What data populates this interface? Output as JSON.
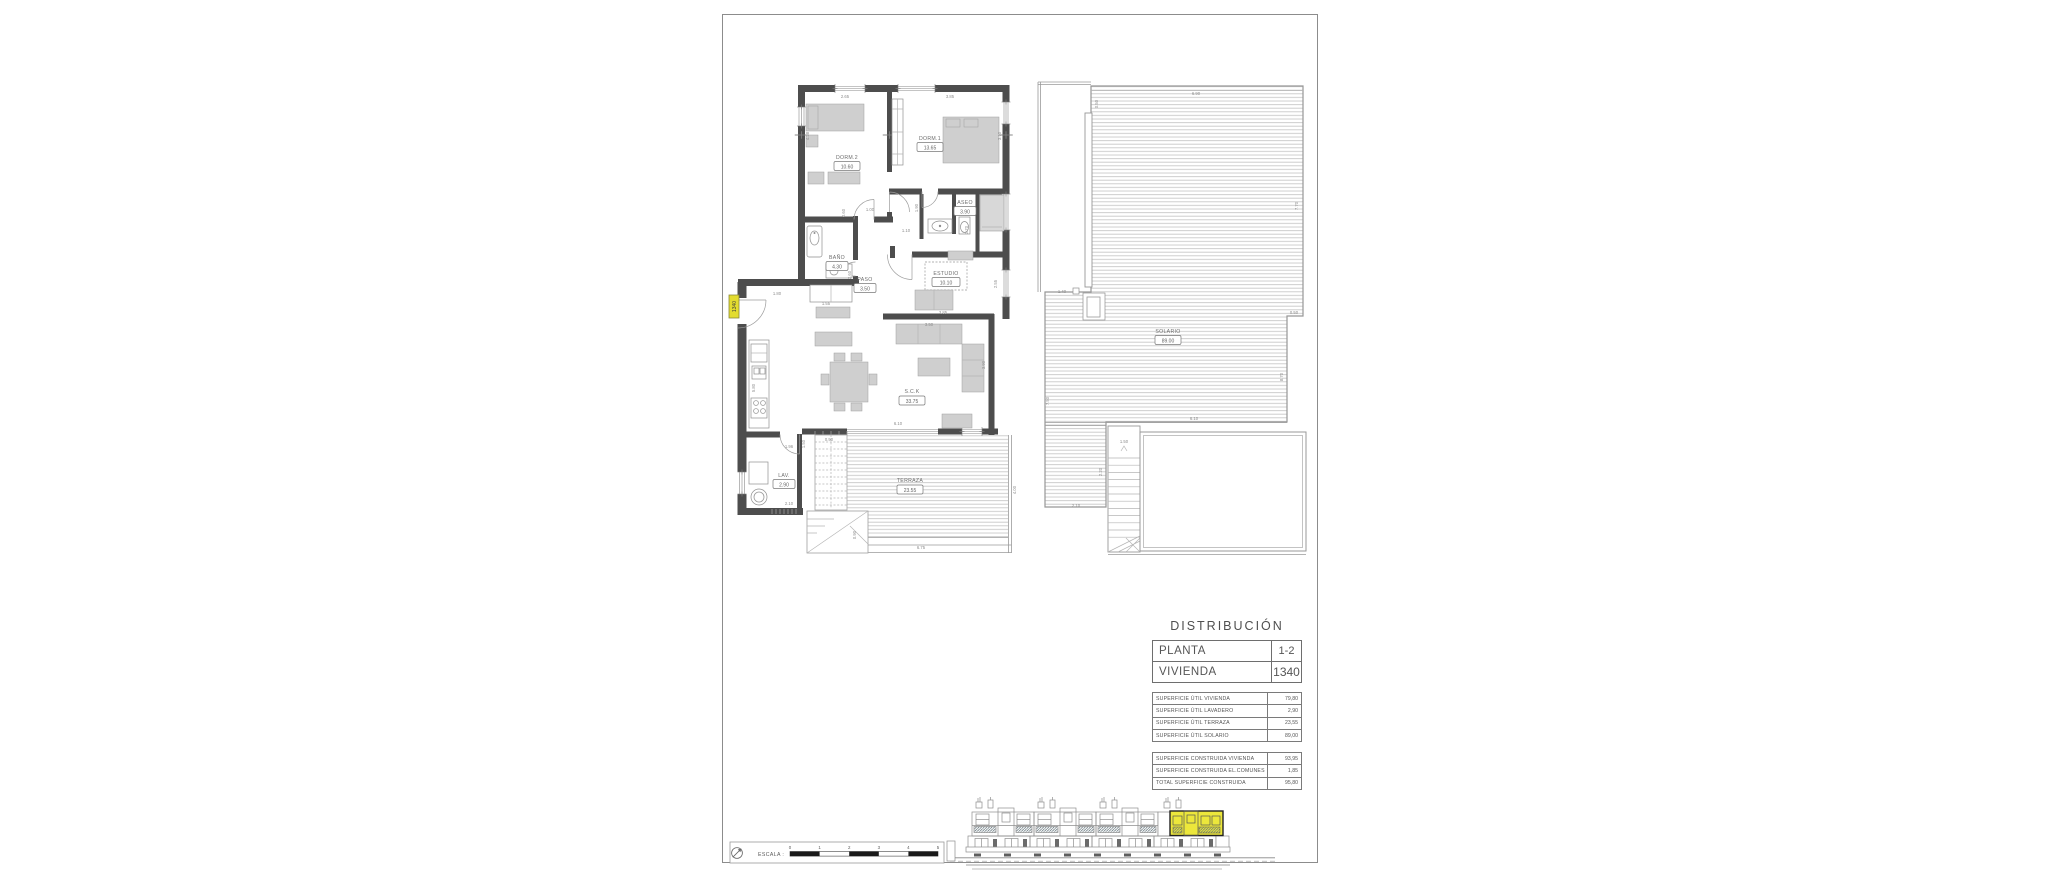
{
  "plan": {
    "rooms": [
      {
        "name": "DORM.2",
        "area": "10.60"
      },
      {
        "name": "DORM.1",
        "area": "13.65"
      },
      {
        "name": "ASEO",
        "area": "3.90"
      },
      {
        "name": "BAÑO",
        "area": "4.30"
      },
      {
        "name": "PASO",
        "area": "3.50"
      },
      {
        "name": "ESTUDIO",
        "area": "10.10"
      },
      {
        "name": "S.C.K",
        "area": "33.75"
      },
      {
        "name": "LAV.",
        "area": "2.90"
      },
      {
        "name": "TERRAZA",
        "area": "23.55"
      },
      {
        "name": "SOLARIO",
        "area": "89.00"
      }
    ],
    "unit_tag": "1340",
    "dims": [
      "2.65",
      "3.85",
      "4.28",
      "3.10",
      "1.00",
      "0.60",
      "1.90",
      "1.10",
      "2.70",
      "2.60",
      "1.55",
      "1.80",
      "3.85",
      "3.50",
      "2.55",
      "3.90",
      "5.80",
      "6.10",
      "1.96",
      "1.50",
      "0.90",
      "2.10",
      "0.90",
      "6.75",
      "4.00",
      "6.90",
      "0.50",
      "7.70",
      "1.40",
      "0.50",
      "8.70",
      "7.50",
      "6.10",
      "1.50",
      "2.20",
      "2.10"
    ]
  },
  "distribution": {
    "title": "DISTRIBUCIÓN",
    "planta_label": "PLANTA",
    "planta_value": "1-2",
    "vivienda_label": "VIVIENDA",
    "vivienda_value": "1340",
    "util_rows": [
      {
        "label": "SUPERFICIE ÚTIL VIVIENDA",
        "value": "79,80"
      },
      {
        "label": "SUPERFICIE ÚTIL LAVADERO",
        "value": "2,90"
      },
      {
        "label": "SUPERFICIE ÚTIL TERRAZA",
        "value": "23,55"
      },
      {
        "label": "SUPERFICIE ÚTIL SOLARIO",
        "value": "89,00"
      }
    ],
    "constructed_rows": [
      {
        "label": "SUPERFICIE CONSTRUIDA VIVIENDA",
        "value": "93,95"
      },
      {
        "label": "SUPERFICIE CONSTRUIDA EL.COMUNES",
        "value": "1,85"
      },
      {
        "label": "TOTAL SUPERFICIE CONSTRUIDA",
        "value": "95,80"
      }
    ]
  },
  "scale_bar": {
    "label": "ESCALA :",
    "ticks": [
      "0",
      "1",
      "2",
      "3",
      "4",
      "5"
    ]
  },
  "colors": {
    "highlight_yellow": "#e8e23a",
    "wall_gray": "#4d4d4d"
  }
}
